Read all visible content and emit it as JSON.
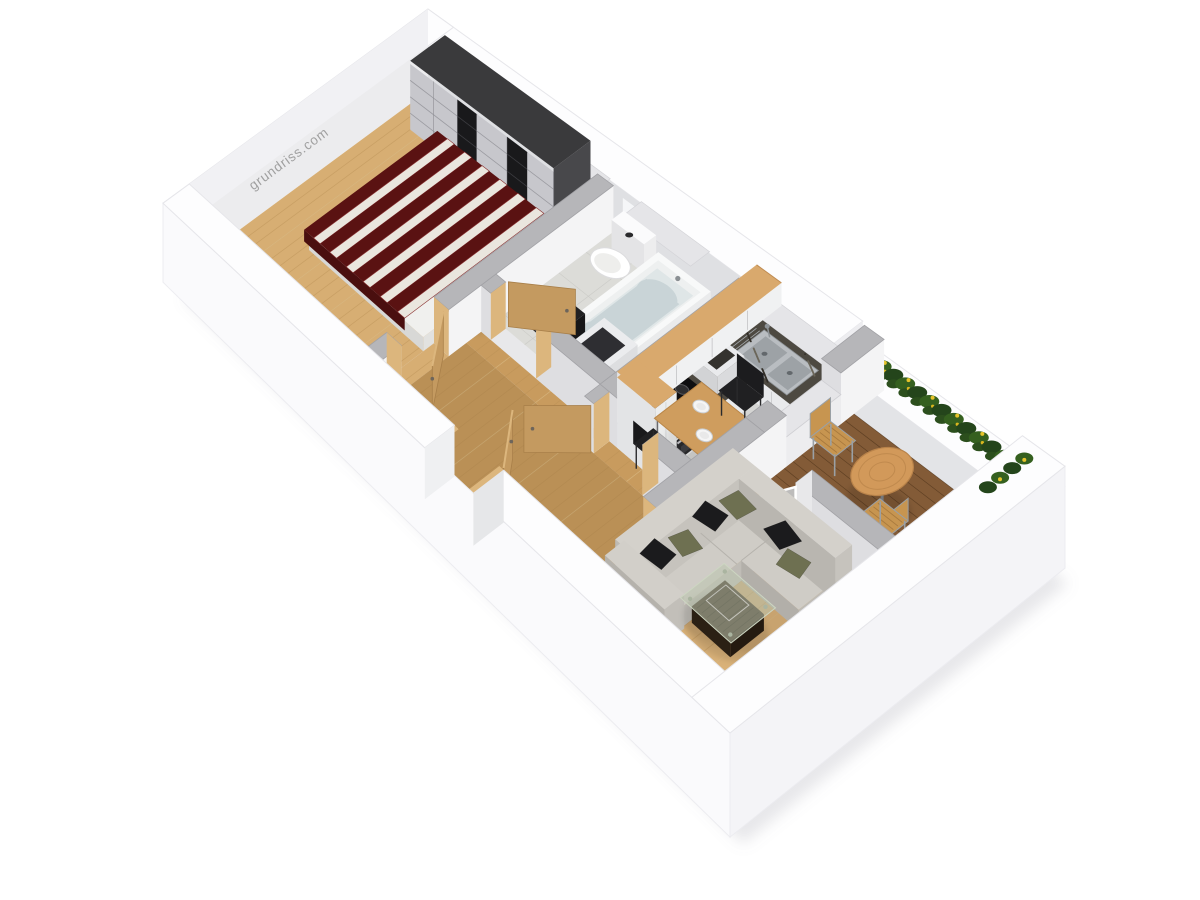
{
  "scene": {
    "description": "3D isometric rendering of a one-bedroom apartment floor plan",
    "watermark": {
      "text": "grundriss.com",
      "color": "#9c9c9c"
    }
  },
  "rooms": [
    {
      "name": "bedroom"
    },
    {
      "name": "bathroom"
    },
    {
      "name": "kitchen"
    },
    {
      "name": "hallway"
    },
    {
      "name": "living-room"
    },
    {
      "name": "balcony"
    }
  ],
  "furniture": [
    "wardrobe",
    "double-bed",
    "toilet",
    "bathtub",
    "washing-machine",
    "bags",
    "kitchen-counter",
    "sink",
    "cooktop",
    "oven",
    "upper-cabinets",
    "tall-cabinet",
    "dining-table",
    "dining-chairs",
    "corner-sofa",
    "pillows",
    "coffee-table",
    "potted-plant",
    "balcony-table",
    "balcony-chairs",
    "flower-boxes",
    "entrance-door",
    "bedroom-door",
    "bathroom-door",
    "kitchen-door",
    "balcony-glass-door"
  ],
  "palette": {
    "background": "#ffffff",
    "shadow": "rgba(140,140,150,0.20)",
    "outer_wall_top": "#fdfdfe",
    "outer_face_sw": "#fafafc",
    "outer_face_se": "#f4f4f7",
    "outer_face_nw": "#f1f1f4",
    "inner_face_ne": "#dfe0e3",
    "inner_face_nw": "#ececee",
    "window_glass": "#f5f6f8",
    "window_sill": "#e5e5e8",
    "wall_top": "#b6b6b9",
    "wall_face_light": "#f4f4f5",
    "wall_face_shade": "#dedee1",
    "wood_floor": "#d7ae73",
    "wood_floor_hall": "#c89b5e",
    "wood_floor_living": "#d9b178",
    "wood_line": "#b88f54",
    "wood_light": "#e8cd9a",
    "tile_floor": "#d5d5d3",
    "tile_line": "#c1c1bf",
    "marble_floor": "#dcdcd8",
    "marble_line": "#c9c9c5",
    "deck": "#7b5431",
    "deck_dark": "#5e3f22",
    "deck_light": "#8d6340",
    "granite": "#4d4941",
    "granite_dot1": "#6b665a",
    "granite_dot2": "#332f28",
    "cabinet": "#e9eaec",
    "cabinet_shade": "#d8d9db",
    "beech": "#d9a96d",
    "beech_dark": "#c08c52",
    "steel": "#b9bdc1",
    "steel_dark": "#8f9498",
    "cooktop": "#0f0f11",
    "oven": "#2b2b2e",
    "wardrobe_top": "#3a3a3c",
    "wardrobe_side": "#48484b",
    "wardrobe_panel_light": "#c7c7cc",
    "wardrobe_panel_dark": "#19191b",
    "bed_frame": "#f0f0ee",
    "duvet_red": "#5a1212",
    "duvet_white": "#eae6de",
    "door_wood": "#c49a60",
    "door_wood_light": "#dcb67d",
    "sofa_top": "#cfccc6",
    "sofa_face": "#bfbcb6",
    "sofa_shade": "#b2afa9",
    "pillow_dark": "#1b1b1d",
    "pillow_olive": "#6e7051",
    "glass": "rgba(187,197,175,0.55)",
    "table_base": "#2f2418",
    "dining_top": "#cf9d5e",
    "chair_black": "#202022",
    "balcony_table": "#d2995a",
    "balcony_wood": "#c79550",
    "metal": "#9aa0a5",
    "plant_dark": "#1e5c18",
    "plant_mid": "#2e7f22",
    "plant_light": "#7fb23c",
    "flower_green_dark": "#24451b",
    "flower_green": "#35601f",
    "flower_yellow": "#e6c32a",
    "strip_dark": "#3a2a19",
    "tub_water": "#c9d4d7",
    "white": "#ffffff"
  }
}
